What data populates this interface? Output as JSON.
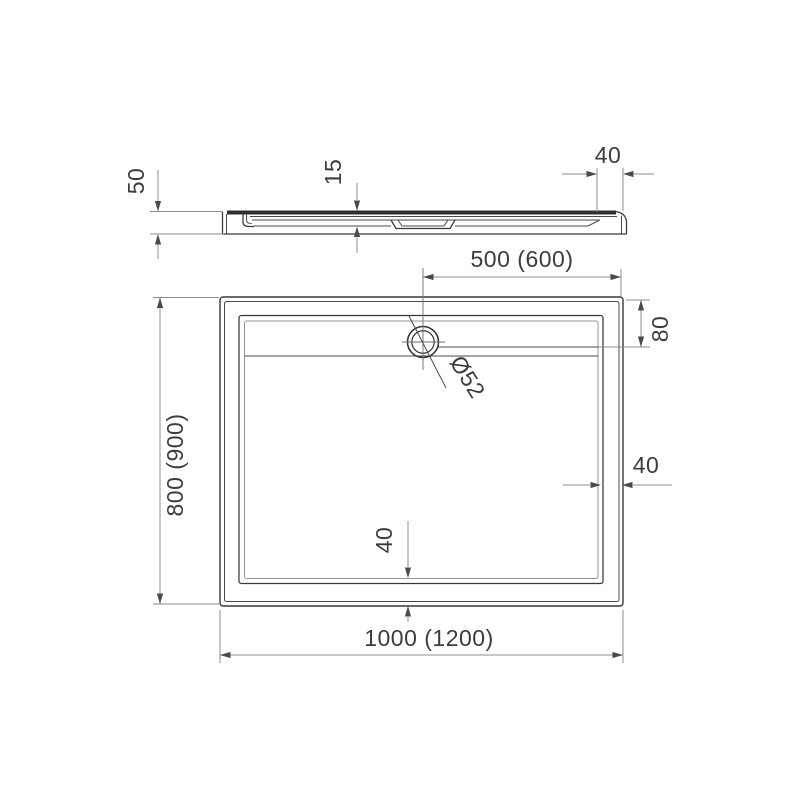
{
  "drawing": {
    "title": "shower-tray-technical-drawing",
    "side_view": {
      "height": "50",
      "inner_depth": "15",
      "rim_width": "40"
    },
    "plan_view": {
      "drain_offset": "500 (600)",
      "shelf_depth": "80",
      "drain_diameter": "Ø52",
      "rim_width_right": "40",
      "rim_width_bottom": "40",
      "depth": "800 (900)",
      "width": "1000 (1200)"
    },
    "colors": {
      "object_line": "#383838",
      "dimension_line": "#8c8c8c",
      "text": "#3c3c3c",
      "background": "#ffffff"
    }
  }
}
